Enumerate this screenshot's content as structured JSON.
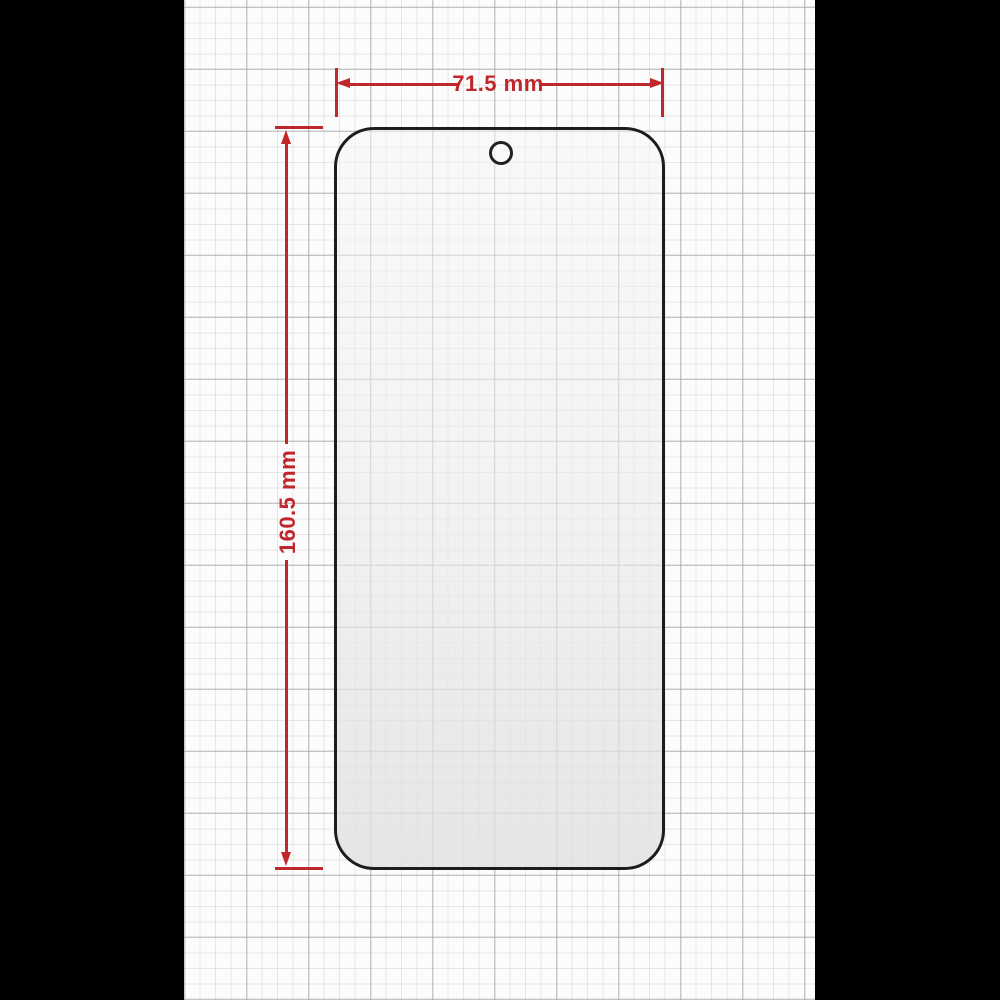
{
  "diagram": {
    "subject": "screen-protector-outline",
    "dimensions": {
      "width": {
        "label": "71.5 mm",
        "value": "71.5",
        "unit": "mm"
      },
      "height": {
        "label": "160.5 mm",
        "value": "160.5",
        "unit": "mm"
      }
    },
    "features": {
      "camera_hole": "punch-hole-top-center"
    },
    "colors": {
      "dimension_red": "#c0272b",
      "outline_black": "#1d1d1d",
      "paper_white": "#fcfcfc",
      "grid_gray": "#bdbdbd",
      "letterbox_black": "#000000"
    }
  }
}
